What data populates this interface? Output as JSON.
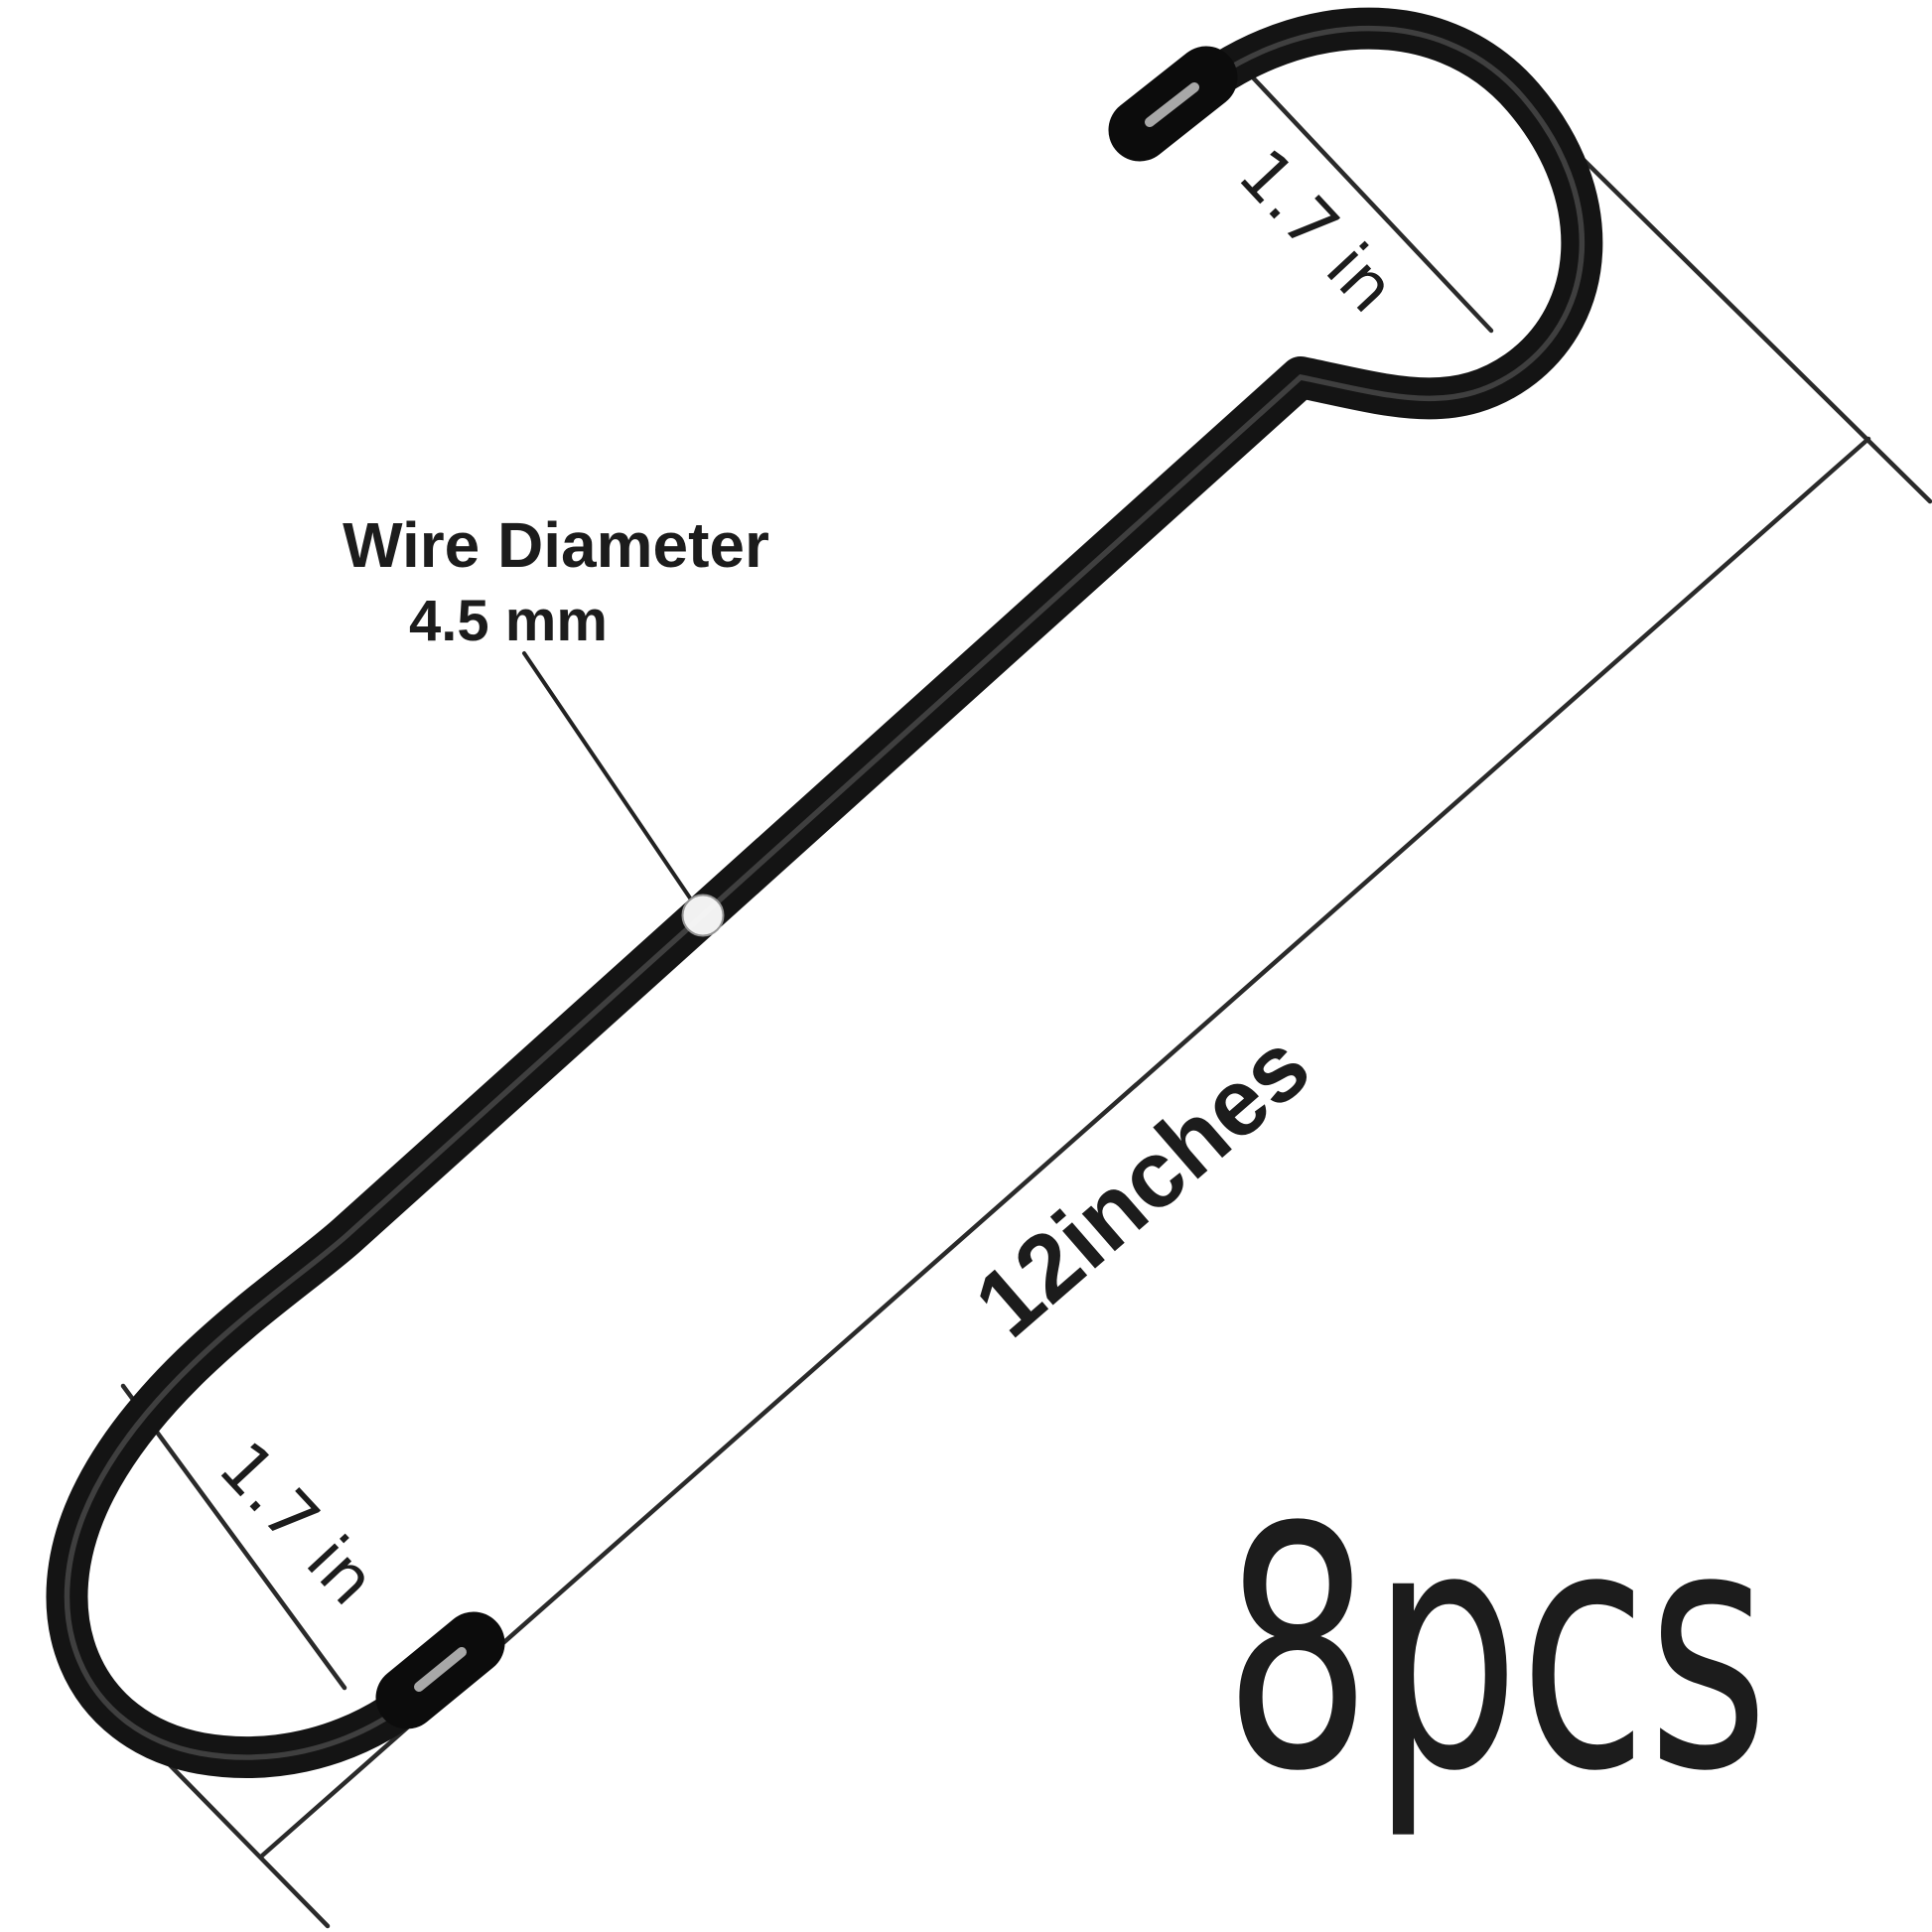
{
  "diagram": {
    "background_color": "#ffffff",
    "ink_color": "#1c1c1c",
    "wire_color": "#141414",
    "thin_line_color": "#2a2a2a",
    "cross_section_dot_color": "#fdfdfd",
    "annotations": {
      "wire_diameter_label": "Wire Diameter",
      "wire_diameter_value": "4.5 mm",
      "top_hook_opening": "1.7 in",
      "bottom_hook_opening": "1.7 in",
      "overall_length": "12inches",
      "quantity": "8pcs"
    }
  }
}
